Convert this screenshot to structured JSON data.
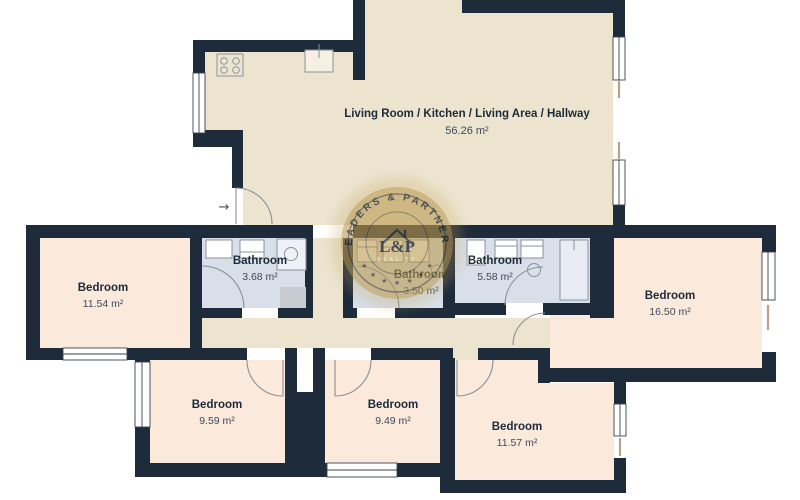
{
  "floorplan": {
    "rooms": {
      "living": {
        "name": "Living Room / Kitchen / Living Area / Hallway",
        "area": "56.26 m²"
      },
      "bedroom_left": {
        "name": "Bedroom",
        "area": "11.54 m²"
      },
      "bathroom_1": {
        "name": "Bathroom",
        "area": "3.68 m²"
      },
      "bathroom_2": {
        "name": "Bathroom",
        "area": "3.50 m²"
      },
      "bathroom_3": {
        "name": "Bathroom",
        "area": "5.58 m²"
      },
      "bedroom_right": {
        "name": "Bedroom",
        "area": "16.50 m²"
      },
      "bedroom_bottom_left": {
        "name": "Bedroom",
        "area": "9.59 m²"
      },
      "bedroom_bottom_middle": {
        "name": "Bedroom",
        "area": "9.49 m²"
      },
      "bedroom_bottom_right": {
        "name": "Bedroom",
        "area": "11.57 m²"
      }
    },
    "entrance": {
      "arrow": "→"
    },
    "watermark": {
      "arc_text": "LEADERS & PARTNERS",
      "monogram": "L&P",
      "subtitle": "REALITY",
      "star": "★"
    },
    "colors": {
      "wall": "#1E2B3A",
      "living_floor": "#ECE4CF",
      "bedroom_floor": "#FBE9DC",
      "bathroom_floor": "#D8DFE9",
      "watermark_gold": "#BB9A4D"
    }
  }
}
